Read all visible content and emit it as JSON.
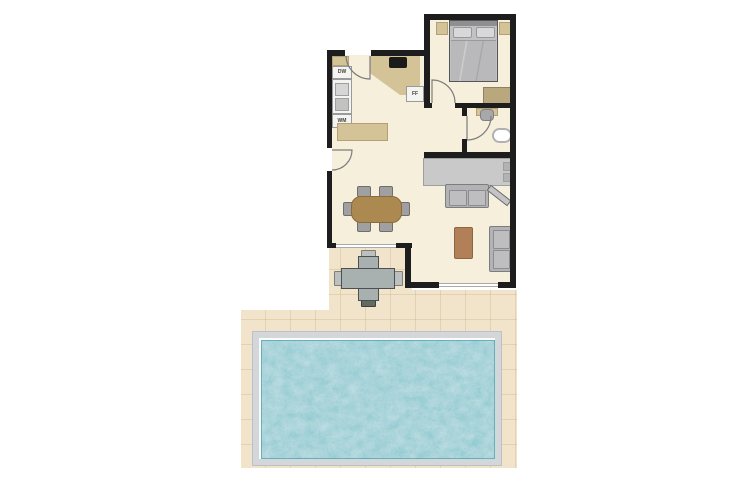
{
  "plan": {
    "labels": {
      "dishwasher": "DW",
      "washing_machine": "WM",
      "fridge_freezer": "FF"
    },
    "colors": {
      "wall": "#1d1d1d",
      "interior_floor": "#f6efdc",
      "counter_tan": "#d5c398",
      "furniture_gray": "#b3b3b5",
      "dining_table_wood": "#ac8950",
      "coffee_table_wood": "#b28058",
      "terrace_paving": "#f1e4cb",
      "pool_frame": "#d4d7da",
      "pool_water": "#53b5c2"
    }
  }
}
